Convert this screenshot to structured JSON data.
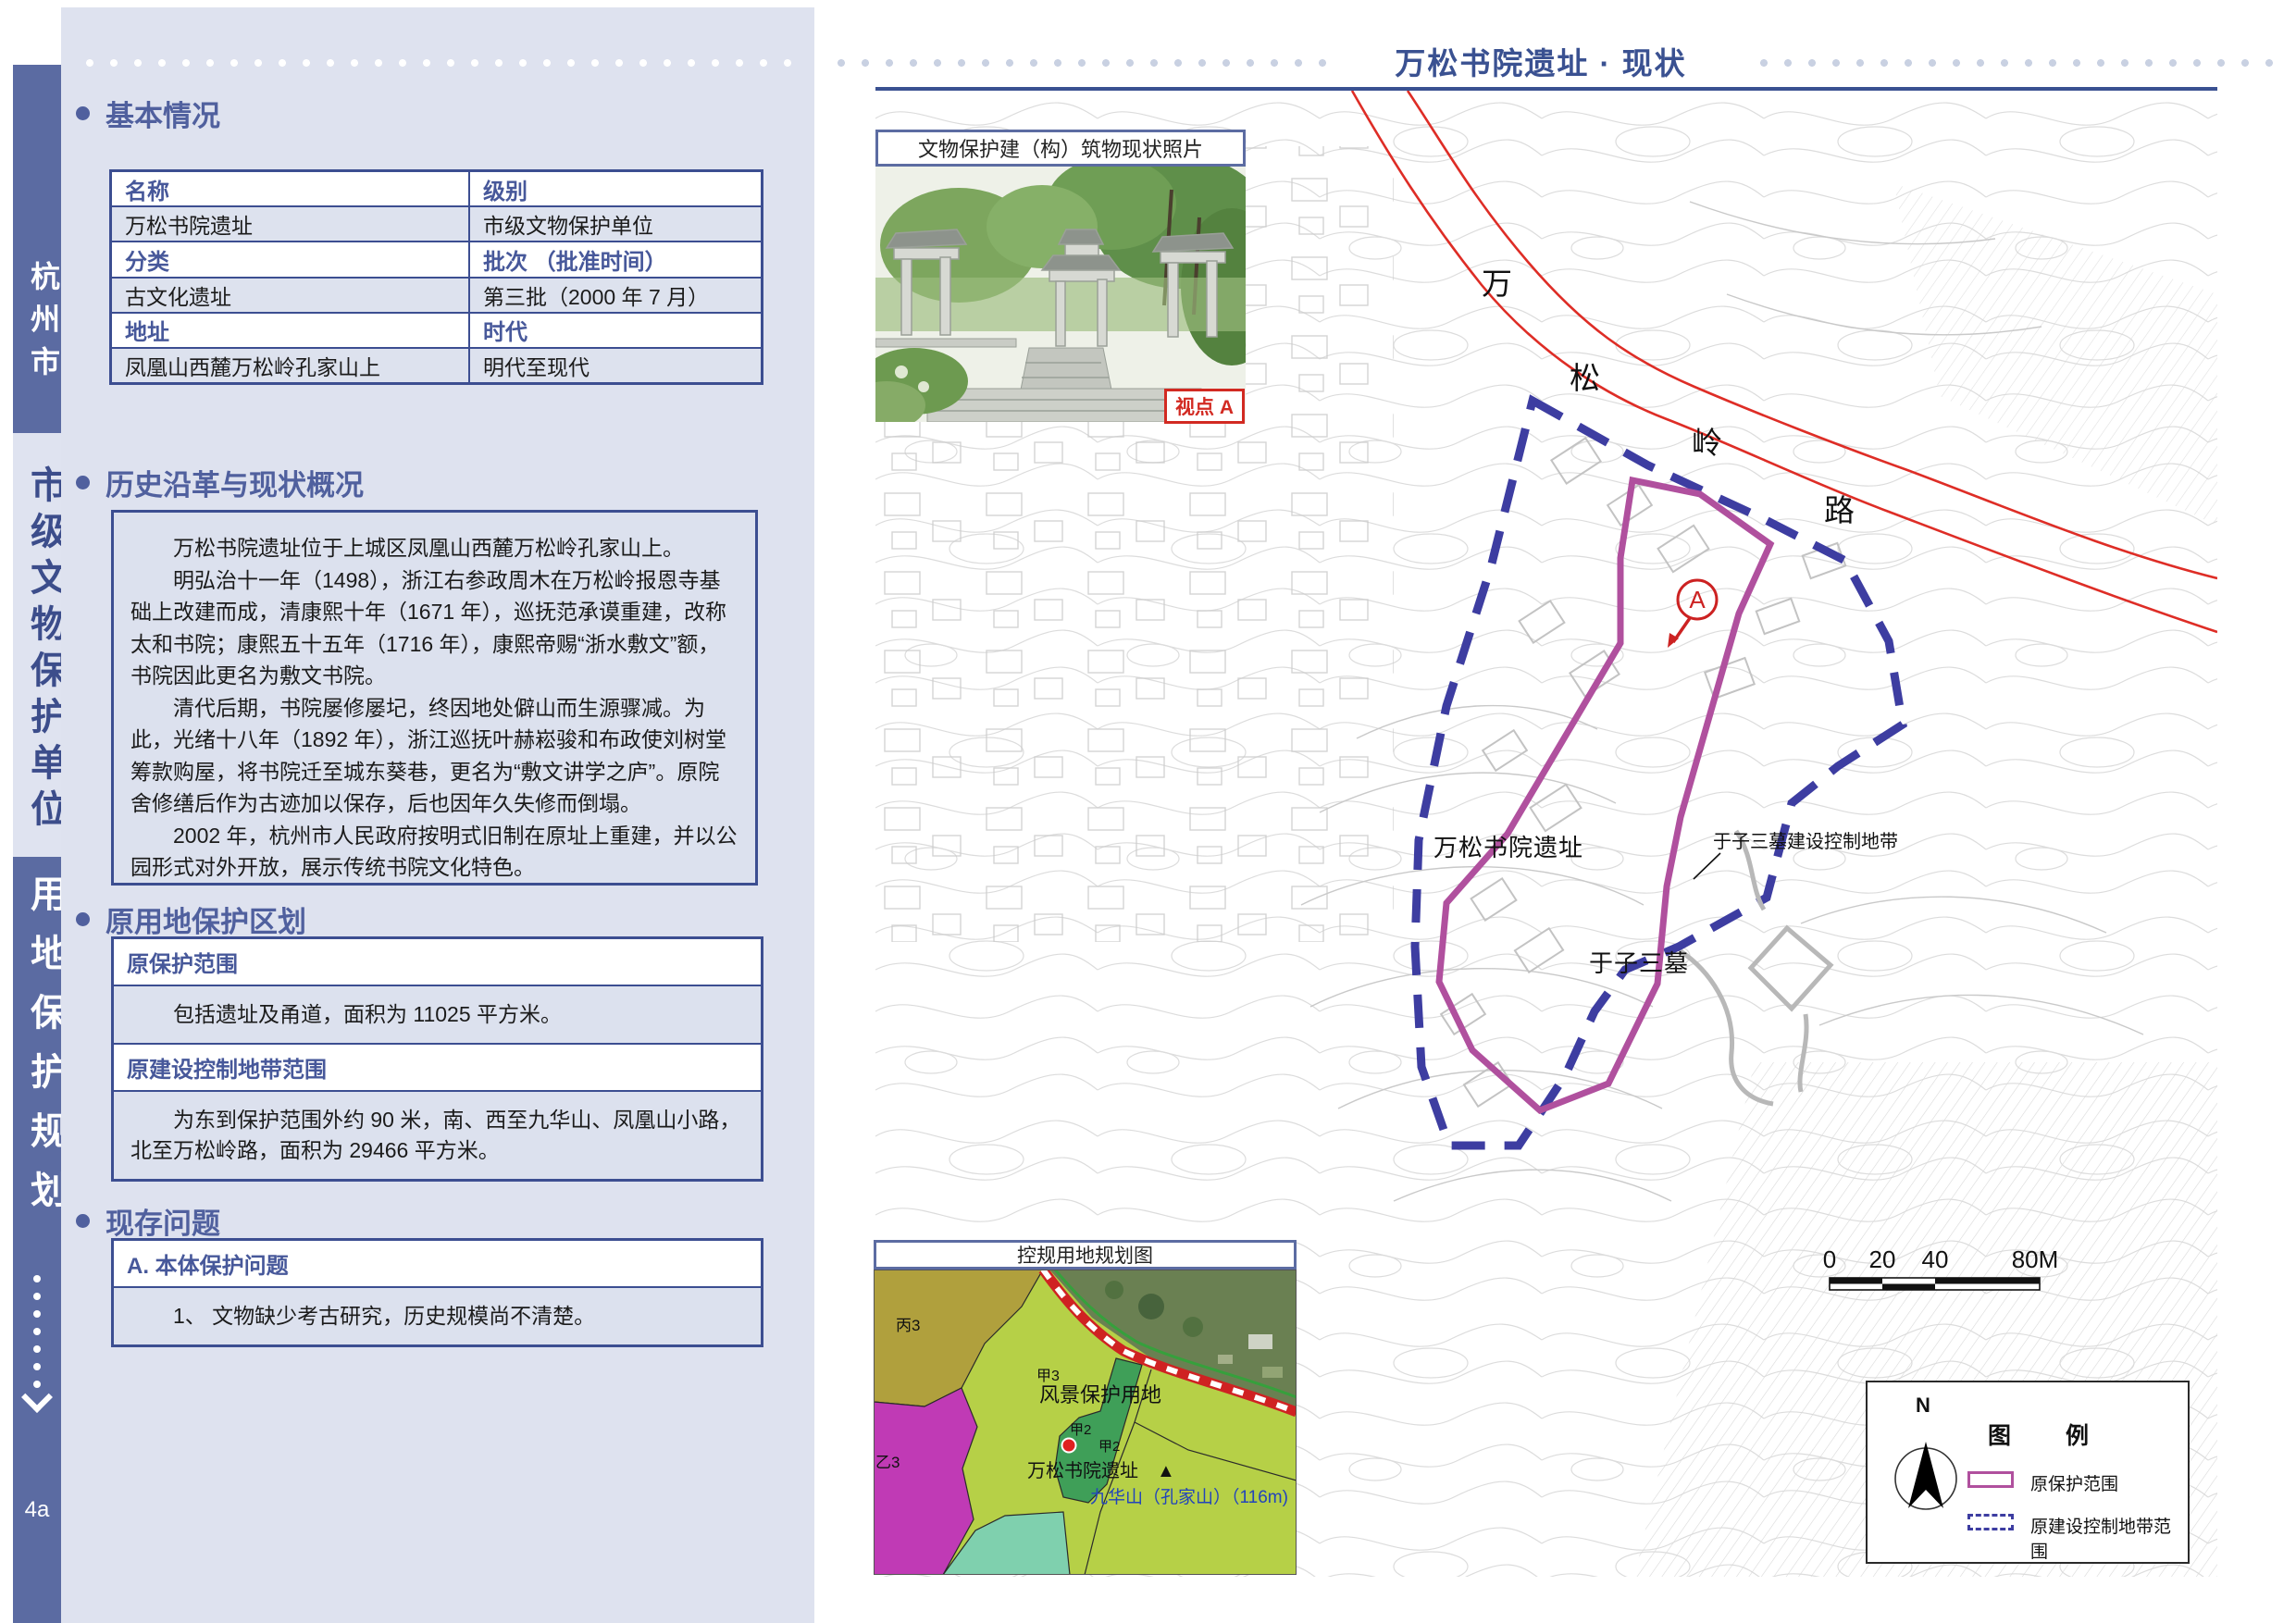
{
  "sidebar": {
    "city": "杭州市",
    "unit_type": "市级文物保护单位",
    "plan_type": "用地保护规划",
    "page_number": "4a"
  },
  "header": {
    "title": "万松书院遗址 · 现状"
  },
  "basic_info": {
    "heading": "基本情况",
    "rows": [
      {
        "left": "名称",
        "right": "级别"
      },
      {
        "left": "万松书院遗址",
        "right": "市级文物保护单位"
      },
      {
        "left": "分类",
        "right": "批次 （批准时间）"
      },
      {
        "left": "古文化遗址",
        "right": "第三批（2000 年 7 月）"
      },
      {
        "left": "地址",
        "right": "时代"
      },
      {
        "left": "凤凰山西麓万松岭孔家山上",
        "right": "明代至现代"
      }
    ]
  },
  "history": {
    "heading": "历史沿革与现状概况",
    "paragraphs": [
      "万松书院遗址位于上城区凤凰山西麓万松岭孔家山上。",
      "明弘治十一年（1498），浙江右参政周木在万松岭报恩寺基础上改建而成，清康熙十年（1671 年），巡抚范承谟重建，改称太和书院；康熙五十五年（1716 年），康熙帝赐“浙水敷文”额，书院因此更名为敷文书院。",
      "清代后期，书院屡修屡圮，终因地处僻山而生源骤减。为此，光绪十八年（1892 年），浙江巡抚叶赫崧骏和布政使刘树堂筹款购屋，将书院迁至城东葵巷，更名为“敷文讲学之庐”。原院舍修缮后作为古迹加以保存，后也因年久失修而倒塌。",
      "2002 年，杭州市人民政府按明式旧制在原址上重建，并以公园形式对外开放，展示传统书院文化特色。"
    ]
  },
  "zoning": {
    "heading": "原用地保护区划",
    "items": [
      {
        "label": "原保护范围",
        "text": "包括遗址及甬道，面积为 11025 平方米。"
      },
      {
        "label": "原建设控制地带范围",
        "text": "为东到保护范围外约 90 米，南、西至九华山、凤凰山小路，北至万松岭路，面积为 29466 平方米。"
      }
    ]
  },
  "problems": {
    "heading": "现存问题",
    "items": [
      {
        "label": "A. 本体保护问题",
        "text": "1、 文物缺少考古研究，历史规模尚不清楚。"
      }
    ]
  },
  "photo_inset": {
    "title": "文物保护建（构）筑物现状照片",
    "viewpoint_label": "视点 A"
  },
  "map": {
    "road_chars": [
      "万",
      "松",
      "岭",
      "路"
    ],
    "site_label": "万松书院遗址",
    "tomb_label": "于子三墓",
    "tomb_zone_label": "于子三墓建设控制地带",
    "viewpoint": "A",
    "scale_ticks": [
      "0",
      "20",
      "40",
      "80M"
    ],
    "legend": {
      "title": "图 例",
      "north_label": "N",
      "items": [
        {
          "label": "原保护范围",
          "style": "solid",
          "color": "#b0509e"
        },
        {
          "label": "原建设控制地带范围",
          "style": "dashed",
          "color": "#3d3da1"
        }
      ]
    },
    "colors": {
      "protection_boundary": "#b0509e",
      "control_boundary": "#3d3da1",
      "road": "#de2d26",
      "contour": "#d3d3d3"
    }
  },
  "planning_inset": {
    "title": "控规用地规划图",
    "labels": {
      "zone_c3": "丙3",
      "zone_y3": "乙3",
      "zone_j3": "甲3",
      "scenic": "风景保护用地",
      "zone_j2a": "甲2",
      "zone_j2b": "甲2",
      "site": "万松书院遗址",
      "peak_marker": "▲",
      "peak": "九华山（孔家山）（116m)"
    }
  }
}
